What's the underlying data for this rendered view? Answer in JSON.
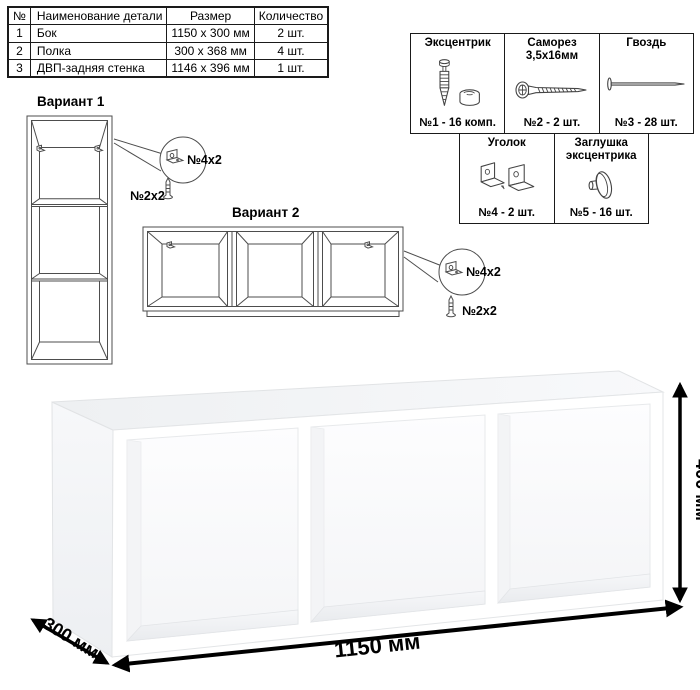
{
  "parts_table": {
    "headers": {
      "num": "№",
      "name": "Наименование детали",
      "size": "Размер",
      "qty": "Количество"
    },
    "rows": [
      {
        "num": "1",
        "name": "Бок",
        "size": "1150 x 300 мм",
        "qty": "2 шт."
      },
      {
        "num": "2",
        "name": "Полка",
        "size": "300 x 368 мм",
        "qty": "4 шт."
      },
      {
        "num": "3",
        "name": "ДВП-задняя стенка",
        "size": "1146 x 396 мм",
        "qty": "1 шт."
      }
    ]
  },
  "hardware": {
    "items": [
      {
        "title": "Эксцентрик",
        "title2": "",
        "label": "№1 - 16 комп.",
        "icon": "eccentric-cam-icon"
      },
      {
        "title": "Саморез",
        "title2": "3,5х16мм",
        "label": "№2 - 2 шт.",
        "icon": "screw-icon"
      },
      {
        "title": "Гвоздь",
        "title2": "",
        "label": "№3 - 28 шт.",
        "icon": "nail-icon"
      },
      {
        "title": "Уголок",
        "title2": "",
        "label": "№4 - 2 шт.",
        "icon": "corner-bracket-icon"
      },
      {
        "title": "Заглушка",
        "title2": "эксцентрика",
        "label": "№5 - 16 шт.",
        "icon": "cam-cap-icon"
      }
    ]
  },
  "variants": {
    "variant1": {
      "title": "Вариант 1",
      "bracket_label": "№4х2",
      "screw_label": "№2х2"
    },
    "variant2": {
      "title": "Вариант 2",
      "bracket_label": "№4х2",
      "screw_label": "№2х2"
    }
  },
  "dimensions": {
    "width": "1150 мм",
    "depth": "300 мм",
    "height": "400 мм"
  },
  "colors": {
    "line": "#4d4d4d",
    "arrow": "#000000",
    "shade": "#f2f3f5"
  }
}
